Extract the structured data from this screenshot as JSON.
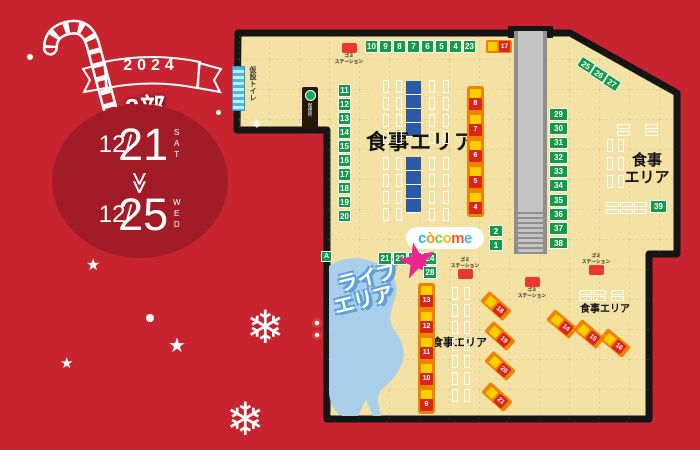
{
  "left_panel": {
    "year": "2024",
    "session_label": "2部",
    "dates": {
      "start": "12/21",
      "start_dow": "SAT",
      "separator": "≫",
      "end": "12/25",
      "end_dow": "WED"
    }
  },
  "map": {
    "areas": {
      "dining_main": "食事エリア",
      "dining_right_line1": "食事",
      "dining_right_line2": "エリア",
      "dining_bottom_center": "食事エリア",
      "dining_bottom_right": "食事エリア",
      "live_line1": "ライブ",
      "live_line2": "エリア"
    },
    "facilities": {
      "toilet": "仮設トイレ",
      "smoking": "喫煙所",
      "trash_line1": "ゴミ",
      "trash_line2": "ステーション",
      "entrance": "A"
    },
    "logo": {
      "letters": [
        {
          "ch": "c",
          "color": "#2eb6e8"
        },
        {
          "ch": "ò",
          "color": "#f6921e"
        },
        {
          "ch": "c",
          "color": "#7ac943"
        },
        {
          "ch": "o",
          "color": "#fdc010"
        },
        {
          "ch": "m",
          "color": "#f1592a"
        },
        {
          "ch": "e",
          "color": "#35c1ec"
        }
      ]
    },
    "green_booths": {
      "top_row": [
        "10",
        "9",
        "8",
        "7",
        "6",
        "5",
        "4",
        "23"
      ],
      "left_column": [
        "11",
        "12",
        "13",
        "14",
        "15",
        "16",
        "17",
        "18",
        "19",
        "20"
      ],
      "right_column": [
        "29",
        "30",
        "31",
        "32",
        "33",
        "34",
        "35",
        "36",
        "37",
        "38"
      ],
      "diag_top": [
        "25",
        "26",
        "27"
      ],
      "center_row": [
        "21",
        "22",
        "23",
        "24"
      ],
      "center_pair": [
        "2",
        "1"
      ],
      "booth_28": "28",
      "booth_39": "39"
    },
    "food_trucks": {
      "top_single": "17",
      "upper_strip": [
        "8",
        "7",
        "6",
        "5",
        "4"
      ],
      "lower_strip": [
        "13",
        "12",
        "11",
        "10",
        "9"
      ],
      "diag_left": [
        "18",
        "19",
        "20",
        "21"
      ],
      "diag_right": [
        "14",
        "15",
        "16"
      ]
    },
    "decorations": {
      "snowflake_glyph": "❄",
      "star_glyph": "★"
    },
    "colors": {
      "background_red": "#c8242f",
      "circle_red": "#a21c28",
      "map_fill": "#f3e2a3",
      "map_border": "#151515",
      "booth_green": "#149a4b",
      "truck_orange": "#ef8200",
      "truck_yellow": "#fcd000",
      "truck_red": "#da251d",
      "escalator_gray": "#c4c4c4",
      "live_area_blue": "#a9cfeb",
      "table_blue": "#2d5aa8",
      "trash_red": "#e8382f",
      "toilet_cyan": "#49b8e0",
      "logo_star_pink": "#ec268f"
    }
  }
}
